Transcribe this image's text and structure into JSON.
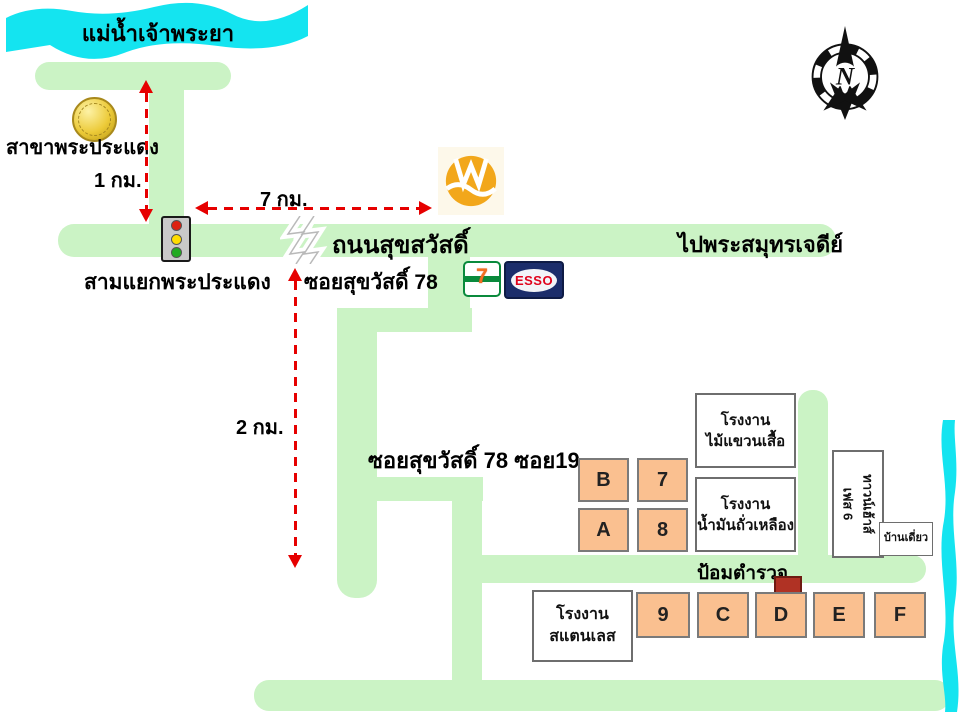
{
  "colors": {
    "road_green": "#cbf3c5",
    "river_cyan": "#14e4f0",
    "block_peach": "#fac090",
    "arrow_red": "#e60000",
    "police_red": "#b03224",
    "coin_gold": "#ecca38",
    "emblem_orange": "#f2a71b",
    "esso_navy": "#1b2d6b",
    "esso_red": "#e0021b",
    "seven_eleven_green": "#0a8a3c",
    "seven_eleven_orange": "#f26f21"
  },
  "rivers": {
    "top_label": "แม่น้ำเจ้าพระยา"
  },
  "compass": {
    "letter": "N"
  },
  "landmarks": {
    "bank_branch": "สาขาพระประแดง",
    "junction": "สามแยกพระประแดง",
    "police_box": "ป้อมตำรวจ",
    "seven_eleven_digit": "7",
    "esso": "ESSO"
  },
  "roads": {
    "main_road": "ถนนสุขสวัสดิ์",
    "direction_right": "ไปพระสมุทรเจดีย์",
    "soi_78": "ซอยสุขวัสดิ์ 78",
    "soi_19": "ซอยสุขวัสดิ์ 78 ซอย19"
  },
  "distances": {
    "to_river": "1 กม.",
    "along_road": "7 กม.",
    "to_soi19": "2 กม."
  },
  "buildings": {
    "factory_hanger": {
      "line1": "โรงงาน",
      "line2": "ไม้แขวนเสื้อ"
    },
    "factory_soybean": {
      "line1": "โรงงาน",
      "line2": "น้ำมันถั่วเหลือง"
    },
    "factory_stainless": {
      "line1": "โรงงาน",
      "line2": "สแตนเลส"
    },
    "townhouse": {
      "line1": "ทาวน์เฮ้าส์",
      "line2": "เฟส 6"
    },
    "detached_house": "บ้านเดี่ยว"
  },
  "blocks": {
    "b": "B",
    "seven": "7",
    "a": "A",
    "eight": "8",
    "nine": "9",
    "c": "C",
    "d": "D",
    "e": "E",
    "f": "F"
  }
}
